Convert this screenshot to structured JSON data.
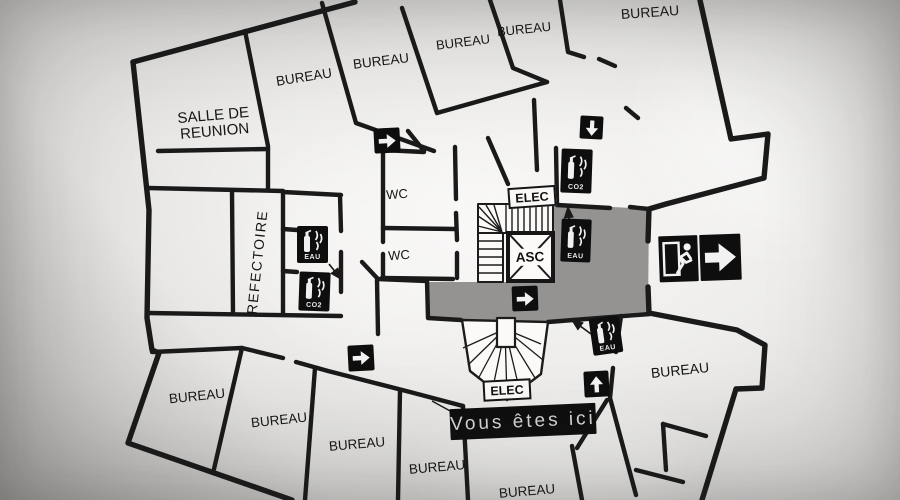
{
  "banner": {
    "label": "Vous êtes ici"
  },
  "rooms": {
    "meeting_line1": "SALLE DE",
    "meeting_line2": "REUNION",
    "refectory": "REFECTOIRE",
    "wc_top": "WC",
    "wc_bottom": "WC",
    "elevator": "ASC",
    "elec_top": "ELEC",
    "elec_bottom": "ELEC"
  },
  "offices": [
    {
      "label": "BUREAU"
    },
    {
      "label": "BUREAU"
    },
    {
      "label": "BUREAU"
    },
    {
      "label": "BUREAU"
    },
    {
      "label": "BUREAU"
    },
    {
      "label": "BUREAU"
    },
    {
      "label": "BUREAU"
    },
    {
      "label": "BUREAU"
    },
    {
      "label": "BUREAU"
    },
    {
      "label": "BUREAU"
    },
    {
      "label": "BUREAU"
    }
  ],
  "extinguishers": [
    {
      "id": "refectory-eau",
      "label": "EAU"
    },
    {
      "id": "refectory-co2",
      "label": "CO2"
    },
    {
      "id": "top-co2",
      "label": "CO2"
    },
    {
      "id": "core-eau",
      "label": "EAU"
    },
    {
      "id": "bottom-eau",
      "label": "EAU"
    }
  ],
  "icons": {
    "arrows": [
      "right",
      "down",
      "right",
      "right",
      "up"
    ],
    "exit_sign": "running-man-right-arrow"
  },
  "colors": {
    "wall": "#1a1a1a",
    "corridor_gray": "#949290",
    "sign_background": "#0e0e0e",
    "sign_glyph": "#f2f2f2",
    "banner_text": "#d6d5d3"
  }
}
